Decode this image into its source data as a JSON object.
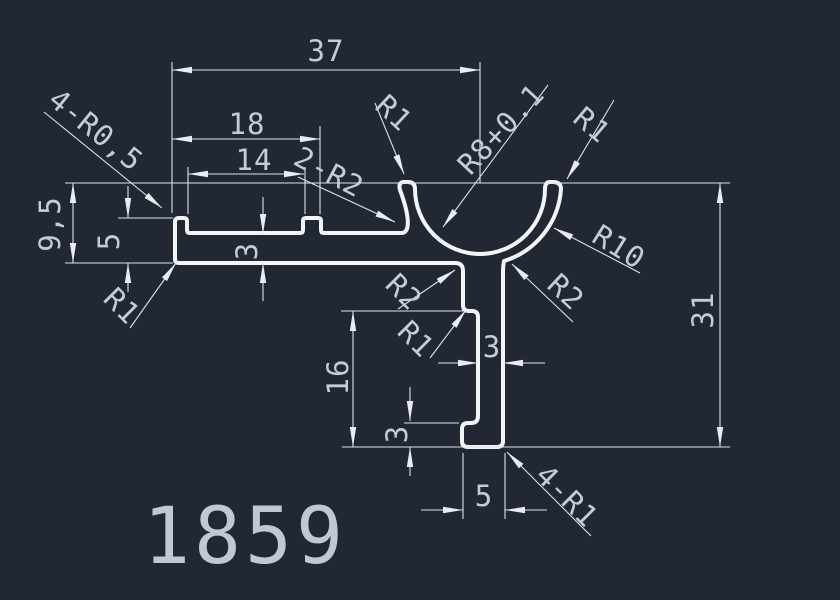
{
  "drawing": {
    "part_number": "1859",
    "background_color": "#212733",
    "line_color": "#dde1e7",
    "profile_line_color": "#f2f4f6",
    "text_color": "#c6ccd6",
    "dimensions": {
      "overall_width": "37",
      "slot_width": "18",
      "slot_inner_width": "14",
      "corner_radii_top_left": "4-R0,5",
      "left_height": "9,5",
      "left_lip_height": "5",
      "bottom_left_corner_radius": "R1",
      "slot_fillet_radii": "2-R2",
      "channel_lip_left_radius": "R1",
      "channel_inner_radius": "R8+0.1",
      "channel_lip_right_radius": "R1",
      "channel_outer_radius": "R10",
      "channel_leg_fillet_right": "R2",
      "overall_height": "31",
      "floor_thickness": "3",
      "leg_fillet_left": "R2",
      "leg_step_radius": "R1",
      "leg_height": "16",
      "leg_thickness": "3",
      "foot_height": "3",
      "foot_width": "5",
      "foot_corner_radii": "4-R1"
    }
  }
}
